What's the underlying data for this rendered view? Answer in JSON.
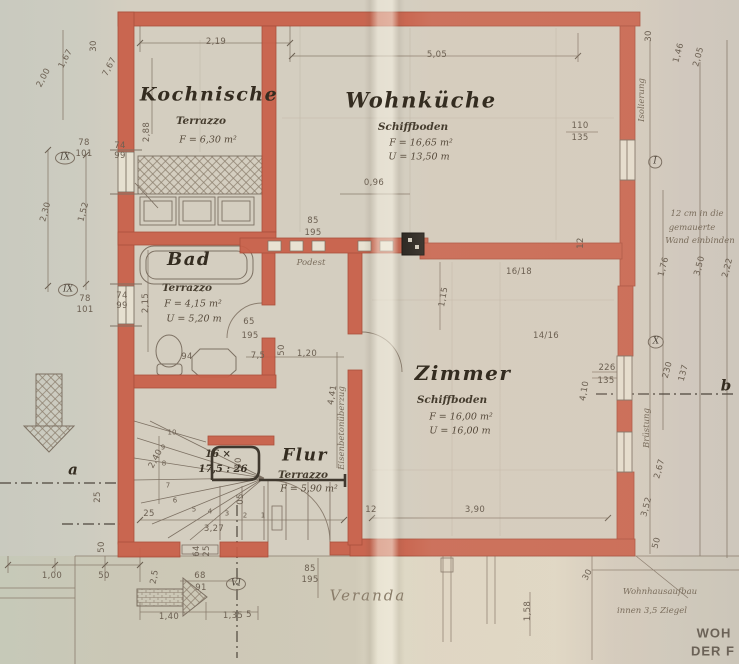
{
  "rooms": [
    {
      "name": "Kochnische",
      "floor": "Terrazzo",
      "area": "F = 6,30 m²",
      "perimeter": null,
      "name_pos": [
        209,
        95,
        19
      ],
      "floor_pos": [
        201,
        121
      ],
      "area_pos": [
        208,
        140
      ],
      "perim_pos": null
    },
    {
      "name": "Wohnküche",
      "floor": "Schiffboden",
      "area": "F = 16,65 m²",
      "perimeter": "U = 13,50 m",
      "name_pos": [
        421,
        100,
        21
      ],
      "floor_pos": [
        413,
        127
      ],
      "area_pos": [
        421,
        143
      ],
      "perim_pos": [
        419,
        157
      ]
    },
    {
      "name": "Bad",
      "floor": "Terrazzo",
      "area": "F = 4,15 m²",
      "perimeter": "U = 5,20 m",
      "name_pos": [
        189,
        260,
        18
      ],
      "floor_pos": [
        187,
        288
      ],
      "area_pos": [
        193,
        304
      ],
      "perim_pos": [
        194,
        319
      ]
    },
    {
      "name": "Zimmer",
      "floor": "Schiffboden",
      "area": "F = 16,00 m²",
      "perimeter": "U = 16,00 m",
      "name_pos": [
        463,
        373,
        20
      ],
      "floor_pos": [
        452,
        400
      ],
      "area_pos": [
        461,
        417
      ],
      "perim_pos": [
        460,
        431
      ]
    },
    {
      "name": "Flur",
      "floor": "Terrazzo",
      "area": "F = 5,90 m²",
      "perimeter": null,
      "name_pos": [
        305,
        456,
        17
      ],
      "floor_pos": [
        303,
        475
      ],
      "area_pos": [
        309,
        489
      ],
      "perim_pos": null
    },
    {
      "name": "Veranda",
      "floor": null,
      "area": null,
      "perimeter": null,
      "pencil": true,
      "name_pos": [
        368,
        596,
        15
      ],
      "floor_pos": null,
      "area_pos": null,
      "perim_pos": null
    }
  ],
  "stair": {
    "label": "16 ×",
    "ratio": "17,5 : 26",
    "label_pos": [
      218,
      455
    ],
    "ratio_pos": [
      223,
      470
    ]
  },
  "dimensions": [
    {
      "t": "2,19",
      "x": 216,
      "y": 42
    },
    {
      "t": "5,05",
      "x": 437,
      "y": 55
    },
    {
      "t": "30",
      "x": 94,
      "y": 46,
      "r": -90
    },
    {
      "t": "1,67",
      "x": 66,
      "y": 59,
      "r": -62
    },
    {
      "t": "2,00",
      "x": 44,
      "y": 78,
      "r": -62
    },
    {
      "t": "7,67",
      "x": 110,
      "y": 67,
      "r": -62
    },
    {
      "t": "2,88",
      "x": 147,
      "y": 132,
      "r": -90
    },
    {
      "t": "74",
      "x": 120,
      "y": 146
    },
    {
      "t": "99",
      "x": 120,
      "y": 156
    },
    {
      "t": "78",
      "x": 84,
      "y": 143
    },
    {
      "t": "101",
      "x": 84,
      "y": 154
    },
    {
      "t": "2,30",
      "x": 46,
      "y": 212,
      "r": -75
    },
    {
      "t": "1,52",
      "x": 84,
      "y": 212,
      "r": -75
    },
    {
      "t": "74",
      "x": 122,
      "y": 296
    },
    {
      "t": "99",
      "x": 122,
      "y": 306
    },
    {
      "t": "78",
      "x": 85,
      "y": 299
    },
    {
      "t": "101",
      "x": 85,
      "y": 310
    },
    {
      "t": "2,15",
      "x": 146,
      "y": 303,
      "r": -90
    },
    {
      "t": "65",
      "x": 249,
      "y": 322
    },
    {
      "t": "195",
      "x": 250,
      "y": 336
    },
    {
      "t": "94",
      "x": 187,
      "y": 357
    },
    {
      "t": "7,5",
      "x": 258,
      "y": 356
    },
    {
      "t": "50",
      "x": 282,
      "y": 350,
      "r": -90
    },
    {
      "t": "1,20",
      "x": 307,
      "y": 354
    },
    {
      "t": "4,41",
      "x": 333,
      "y": 395,
      "r": -80
    },
    {
      "t": "85",
      "x": 313,
      "y": 221
    },
    {
      "t": "195",
      "x": 313,
      "y": 233
    },
    {
      "t": "0,96",
      "x": 374,
      "y": 183
    },
    {
      "t": "110",
      "x": 580,
      "y": 126
    },
    {
      "t": "135",
      "x": 580,
      "y": 138
    },
    {
      "t": "16/18",
      "x": 519,
      "y": 272
    },
    {
      "t": "14/16",
      "x": 546,
      "y": 336
    },
    {
      "t": "12",
      "x": 581,
      "y": 243,
      "r": -90
    },
    {
      "t": "1,15",
      "x": 444,
      "y": 297,
      "r": -80
    },
    {
      "t": "226",
      "x": 607,
      "y": 368
    },
    {
      "t": "135",
      "x": 606,
      "y": 381
    },
    {
      "t": "230",
      "x": 668,
      "y": 370,
      "r": -75
    },
    {
      "t": "137",
      "x": 684,
      "y": 373,
      "r": -75
    },
    {
      "t": "4,10",
      "x": 585,
      "y": 391,
      "r": -80
    },
    {
      "t": "2,40",
      "x": 156,
      "y": 459,
      "r": -62
    },
    {
      "t": "50",
      "x": 239,
      "y": 463,
      "r": -90
    },
    {
      "t": "05",
      "x": 241,
      "y": 499,
      "r": -90
    },
    {
      "t": "25",
      "x": 149,
      "y": 514
    },
    {
      "t": "3,27",
      "x": 214,
      "y": 529
    },
    {
      "t": "25",
      "x": 98,
      "y": 497,
      "r": -90
    },
    {
      "t": "50",
      "x": 102,
      "y": 547,
      "r": -90
    },
    {
      "t": "1,00",
      "x": 52,
      "y": 576
    },
    {
      "t": "50",
      "x": 104,
      "y": 576
    },
    {
      "t": "2,5",
      "x": 155,
      "y": 577,
      "r": -80
    },
    {
      "t": "68",
      "x": 200,
      "y": 576
    },
    {
      "t": "91",
      "x": 201,
      "y": 588
    },
    {
      "t": "64",
      "x": 197,
      "y": 551,
      "r": -90
    },
    {
      "t": "25",
      "x": 207,
      "y": 551,
      "r": -90
    },
    {
      "t": "1,40",
      "x": 169,
      "y": 617
    },
    {
      "t": "1,35",
      "x": 233,
      "y": 616
    },
    {
      "t": "5",
      "x": 249,
      "y": 615
    },
    {
      "t": "85",
      "x": 310,
      "y": 569
    },
    {
      "t": "195",
      "x": 310,
      "y": 580
    },
    {
      "t": "3,90",
      "x": 475,
      "y": 510
    },
    {
      "t": "12",
      "x": 371,
      "y": 510
    },
    {
      "t": "30",
      "x": 588,
      "y": 575,
      "r": -62
    },
    {
      "t": "2,67",
      "x": 660,
      "y": 469,
      "r": -75
    },
    {
      "t": "3,52",
      "x": 647,
      "y": 507,
      "r": -75
    },
    {
      "t": "50",
      "x": 657,
      "y": 543,
      "r": -75
    },
    {
      "t": "1,58",
      "x": 528,
      "y": 611,
      "r": -90
    },
    {
      "t": "1,76",
      "x": 664,
      "y": 267,
      "r": -75
    },
    {
      "t": "3,50",
      "x": 700,
      "y": 266,
      "r": -75
    },
    {
      "t": "2,22",
      "x": 728,
      "y": 268,
      "r": -75
    },
    {
      "t": "30",
      "x": 649,
      "y": 36,
      "r": -90
    },
    {
      "t": "1,46",
      "x": 679,
      "y": 53,
      "r": -75
    },
    {
      "t": "2,05",
      "x": 699,
      "y": 57,
      "r": -75
    }
  ],
  "step_numbers": [
    {
      "t": "10",
      "x": 172,
      "y": 433
    },
    {
      "t": "9",
      "x": 163,
      "y": 448
    },
    {
      "t": "8",
      "x": 164,
      "y": 464
    },
    {
      "t": "7",
      "x": 168,
      "y": 486
    },
    {
      "t": "6",
      "x": 175,
      "y": 501
    },
    {
      "t": "5",
      "x": 194,
      "y": 510
    },
    {
      "t": "4",
      "x": 210,
      "y": 512
    },
    {
      "t": "3",
      "x": 227,
      "y": 514
    },
    {
      "t": "2",
      "x": 245,
      "y": 516
    },
    {
      "t": "1",
      "x": 263,
      "y": 516
    }
  ],
  "axis_markers": [
    {
      "t": "IX",
      "x": 65,
      "y": 158
    },
    {
      "t": "IX",
      "x": 68,
      "y": 290
    },
    {
      "t": "I",
      "x": 655,
      "y": 162
    },
    {
      "t": "X",
      "x": 656,
      "y": 342
    },
    {
      "t": "VI",
      "x": 236,
      "y": 584
    }
  ],
  "axis_letters": [
    {
      "t": "a",
      "x": 73,
      "y": 470
    },
    {
      "t": "b",
      "x": 726,
      "y": 386
    }
  ],
  "notes": [
    {
      "t": "Podest",
      "x": 311,
      "y": 263
    },
    {
      "t": "Isolierung",
      "x": 642,
      "y": 100,
      "r": -90
    },
    {
      "t": "Brüstung",
      "x": 647,
      "y": 428,
      "r": -90
    },
    {
      "t": "Eisenbetonüberzug",
      "x": 342,
      "y": 428,
      "r": -90
    },
    {
      "t": "12 cm in die",
      "x": 697,
      "y": 214
    },
    {
      "t": "gemauerte",
      "x": 692,
      "y": 228
    },
    {
      "t": "Wand einbinden",
      "x": 700,
      "y": 241
    },
    {
      "t": "Wohnhausaufbau",
      "x": 660,
      "y": 592
    },
    {
      "t": "innen 3,5 Ziegel",
      "x": 652,
      "y": 611
    }
  ],
  "print_labels": [
    {
      "t": "WOH",
      "x": 714,
      "y": 633
    },
    {
      "t": "DER F",
      "x": 713,
      "y": 651
    }
  ],
  "colors": {
    "wall_red": "#c95f48",
    "wall_red_edge": "#a84632",
    "pencil": "#8a7d6e",
    "ink": "#342c20",
    "paper": "#d4cec0"
  }
}
